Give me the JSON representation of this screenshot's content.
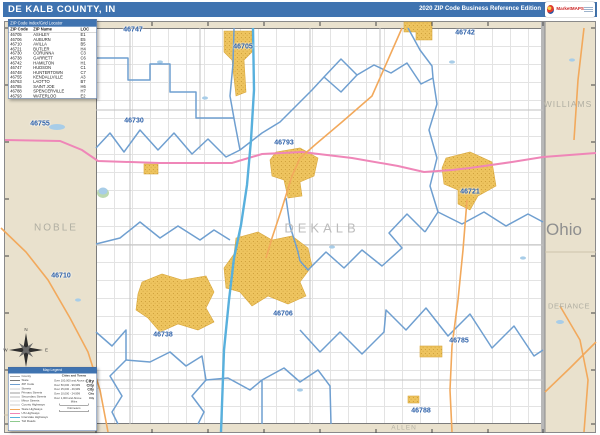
{
  "header": {
    "title": "DE KALB COUNTY, IN",
    "edition": "2020 ZIP Code Business Reference Edition",
    "logo_text": "MarketMAPS",
    "bar_color": "#3f73b0"
  },
  "zip_table": {
    "title": "ZIP Code Index/Grid Locator",
    "columns": [
      "ZIP Code",
      "ZIP Name",
      "LOC"
    ],
    "rows": [
      [
        "46705",
        "ASHLEY",
        "E1"
      ],
      [
        "46706",
        "AUBURN",
        "E5"
      ],
      [
        "46710",
        "AVILLA",
        "B5"
      ],
      [
        "46721",
        "BUTLER",
        "H4"
      ],
      [
        "46730",
        "CORUNNA",
        "C3"
      ],
      [
        "46738",
        "GARRETT",
        "C6"
      ],
      [
        "46742",
        "HAMILTON",
        "H1"
      ],
      [
        "46747",
        "HUDSON",
        "C1"
      ],
      [
        "46748",
        "HUNTERTOWN",
        "C7"
      ],
      [
        "46755",
        "KENDALLVILLE",
        "A3"
      ],
      [
        "46763",
        "LAOTTO",
        "B7"
      ],
      [
        "46785",
        "SAINT JOE",
        "H6"
      ],
      [
        "46788",
        "SPENCERVILLE",
        "H7"
      ],
      [
        "46793",
        "WATERLOO",
        "E2"
      ]
    ]
  },
  "map": {
    "county_label": "DEKALB",
    "state_label": "Ohio",
    "neighbor_counties": {
      "noble": "NOBLE",
      "williams": "WILLIAMS",
      "defiance": "DEFIANCE",
      "allen": "ALLEN"
    },
    "zip_labels": [
      {
        "zip": "46747",
        "x": 133,
        "y": 30
      },
      {
        "zip": "46705",
        "x": 243,
        "y": 47
      },
      {
        "zip": "46742",
        "x": 465,
        "y": 33
      },
      {
        "zip": "46730",
        "x": 134,
        "y": 121
      },
      {
        "zip": "46755",
        "x": 40,
        "y": 124
      },
      {
        "zip": "46793",
        "x": 284,
        "y": 143
      },
      {
        "zip": "46721",
        "x": 470,
        "y": 192
      },
      {
        "zip": "46710",
        "x": 61,
        "y": 276
      },
      {
        "zip": "46706",
        "x": 283,
        "y": 314
      },
      {
        "zip": "46738",
        "x": 163,
        "y": 335
      },
      {
        "zip": "46785",
        "x": 459,
        "y": 341
      },
      {
        "zip": "46788",
        "x": 421,
        "y": 411
      }
    ],
    "colors": {
      "in_county": "#ffffff",
      "out_of_county": "#e9e1cd",
      "zip_boundary": "#6f9fd0",
      "county_border": "#7c7c7c",
      "urban_area": "#eec45f",
      "us_highway": "#ef86b8",
      "state_highway": "#f2a95c",
      "interstate": "#58b0dd",
      "water": "#a8cde8",
      "zip_label": "#2b5fa8"
    }
  },
  "legend": {
    "title": "Map Legend",
    "line_items": [
      {
        "label": "County",
        "color": "#a8a8a8"
      },
      {
        "label": "State",
        "color": "#7a7a7a"
      },
      {
        "label": "ZIP Code",
        "color": "#6f9fd0"
      },
      {
        "label": "Streets",
        "color": "#d0d0d0"
      },
      {
        "label": "Primary Streets",
        "color": "#9c9c9c"
      },
      {
        "label": "Secondary Streets",
        "color": "#b8b8b8"
      },
      {
        "label": "Minor Streets",
        "color": "#dcdcdc"
      },
      {
        "label": "County Highways",
        "color": "#cfcfcf"
      },
      {
        "label": "State Highways",
        "color": "#f2a95c"
      },
      {
        "label": "US Highways",
        "color": "#ef86b8"
      },
      {
        "label": "Interstate Highways",
        "color": "#58b0dd"
      },
      {
        "label": "Toll Roads",
        "color": "#8fca8f"
      }
    ],
    "cities_title": "Cities and Towns",
    "city_classes": [
      {
        "range": "Over 100,000 and Above",
        "sample": "City",
        "size": 9
      },
      {
        "range": "Over 50,000 - 99,999",
        "sample": "City",
        "size": 8
      },
      {
        "range": "Over 25,000 - 49,999",
        "sample": "City",
        "size": 7
      },
      {
        "range": "Over 10,000 - 24,999",
        "sample": "City",
        "size": 6
      },
      {
        "range": "Over 1,000 and Above",
        "sample": "City",
        "size": 5
      }
    ],
    "scales": [
      {
        "label": "Miles"
      },
      {
        "label": "Kilometers"
      }
    ]
  },
  "compass": {
    "n": "N",
    "e": "E",
    "s": "S",
    "w": "W"
  }
}
